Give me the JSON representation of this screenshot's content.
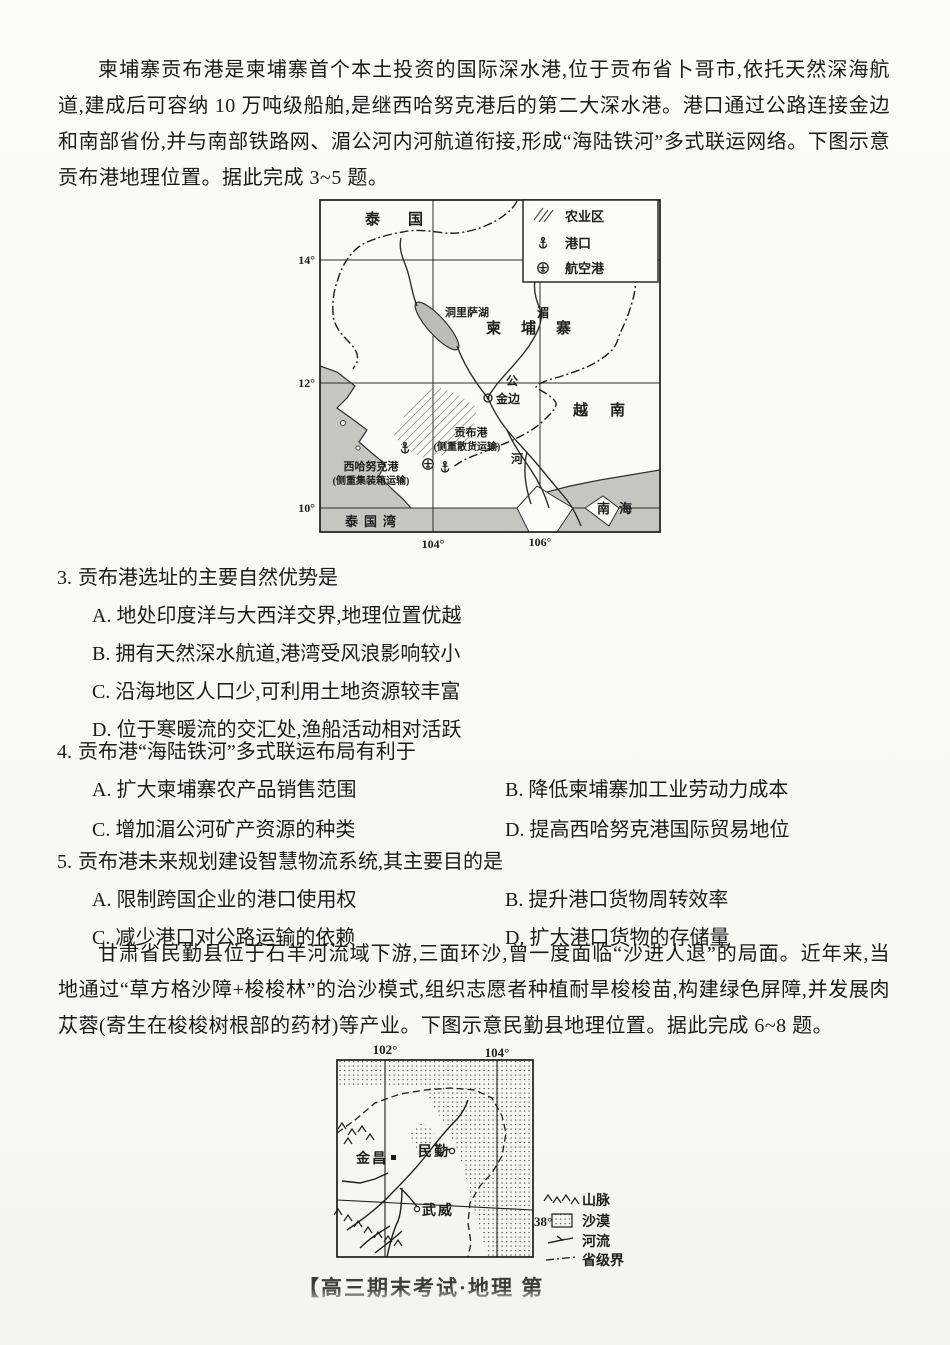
{
  "passages": {
    "p1": "柬埔寨贡布港是柬埔寨首个本土投资的国际深水港,位于贡布省卜哥市,依托天然深海航道,建成后可容纳 10 万吨级船舶,是继西哈努克港后的第二大深水港。港口通过公路连接金边和南部省份,并与南部铁路网、湄公河内河航道衔接,形成“海陆铁河”多式联运网络。下图示意贡布港地理位置。据此完成 3~5 题。",
    "p2": "甘肃省民勤县位于石羊河流域下游,三面环沙,曾一度面临“沙进人退”的局面。近年来,当地通过“草方格沙障+梭梭林”的治沙模式,组织志愿者种植耐旱梭梭苗,构建绿色屏障,并发展肉苁蓉(寄生在梭梭树根部的药材)等产业。下图示意民勤县地理位置。据此完成 6~8 题。"
  },
  "questions": [
    {
      "number": "3.",
      "stem": "贡布港选址的主要自然优势是",
      "options": [
        "A. 地处印度洋与大西洋交界,地理位置优越",
        "B. 拥有天然深水航道,港湾受风浪影响较小",
        "C. 沿海地区人口少,可利用土地资源较丰富",
        "D. 位于寒暖流的交汇处,渔船活动相对活跃"
      ]
    },
    {
      "number": "4.",
      "stem": "贡布港“海陆铁河”多式联运布局有利于",
      "options": [
        "A. 扩大柬埔寨农产品销售范围",
        "B. 降低柬埔寨加工业劳动力成本",
        "C. 增加湄公河矿产资源的种类",
        "D. 提高西哈努克港国际贸易地位"
      ]
    },
    {
      "number": "5.",
      "stem": "贡布港未来规划建设智慧物流系统,其主要目的是",
      "options": [
        "A. 限制跨国企业的港口使用权",
        "B. 提升港口货物周转效率",
        "C. 减少港口对公路运输的依赖",
        "D. 扩大港口货物的存储量"
      ]
    }
  ],
  "map1": {
    "legend": {
      "agri": "农业区",
      "port": "港口",
      "airport": "航空港"
    },
    "labels": {
      "thailand": "泰国",
      "cambodia": "柬埔寨",
      "vietnam": "越南",
      "lake": "洞里萨湖",
      "mekong1": "湄",
      "mekong2": "公",
      "mekong3": "河",
      "phnom_penh": "金边",
      "kampot": "贡布港",
      "kampot_note": "(侧重散货运输)",
      "sihanoukville": "西哈努克港",
      "sihanoukville_note": "(侧重集装箱运输)",
      "gulf": "泰国湾",
      "sea": "南海"
    },
    "lat": [
      "14°",
      "12°",
      "10°"
    ],
    "lon": [
      "104°",
      "106°"
    ]
  },
  "map2": {
    "lon": [
      "102°",
      "104°"
    ],
    "lat": "38°",
    "cities": {
      "jinchang": "金昌",
      "minqin": "民勤",
      "wuwei": "武威"
    },
    "legend": {
      "mountain": "山脉",
      "desert": "沙漠",
      "river": "河流",
      "boundary": "省级界"
    }
  },
  "footer": "【高三期末考试·地理 第"
}
